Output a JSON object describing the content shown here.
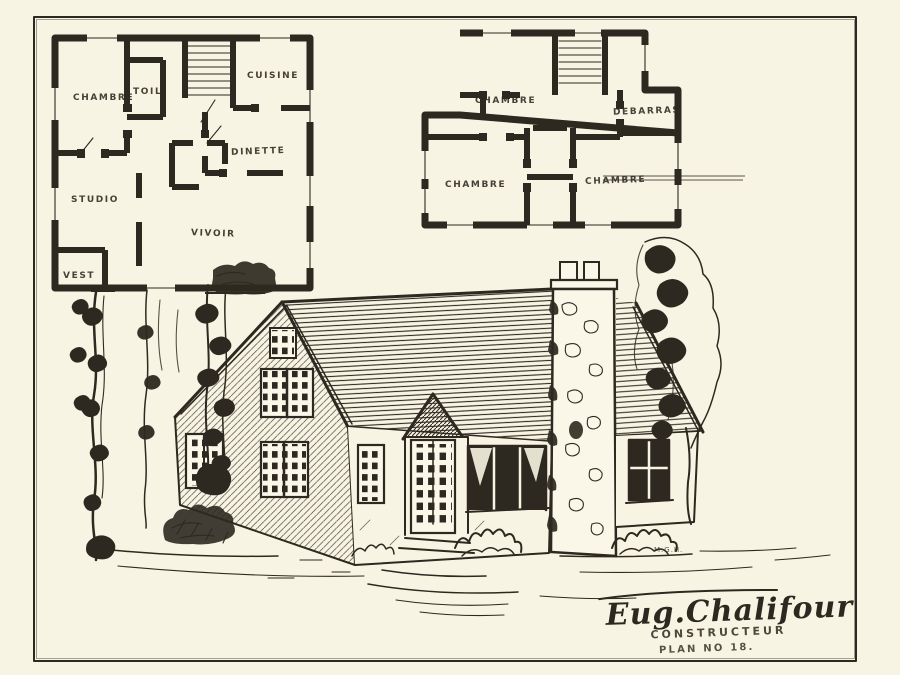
{
  "colors": {
    "paper": "#f8f4e3",
    "ink": "#2e2920"
  },
  "plan_first_floor": {
    "labels": {
      "chambre": "CHAMBRE",
      "toilette": "TOIL",
      "cuisine": "CUISINE",
      "dinette": "DINETTE",
      "studio": "STUDIO",
      "vivoir": "VIVOIR",
      "vestibule": "VEST"
    }
  },
  "plan_second_floor": {
    "labels": {
      "chambre_top": "CHAMBRE",
      "debarras": "DEBARRAS",
      "chambre_left": "CHAMBRE",
      "chambre_right": "CHAMBRE"
    }
  },
  "signature": {
    "name": "Eug.Chalifour",
    "role": "CONSTRUCTEUR",
    "plan_number": "PLAN NO 18.",
    "monogram": "M.G.H."
  }
}
